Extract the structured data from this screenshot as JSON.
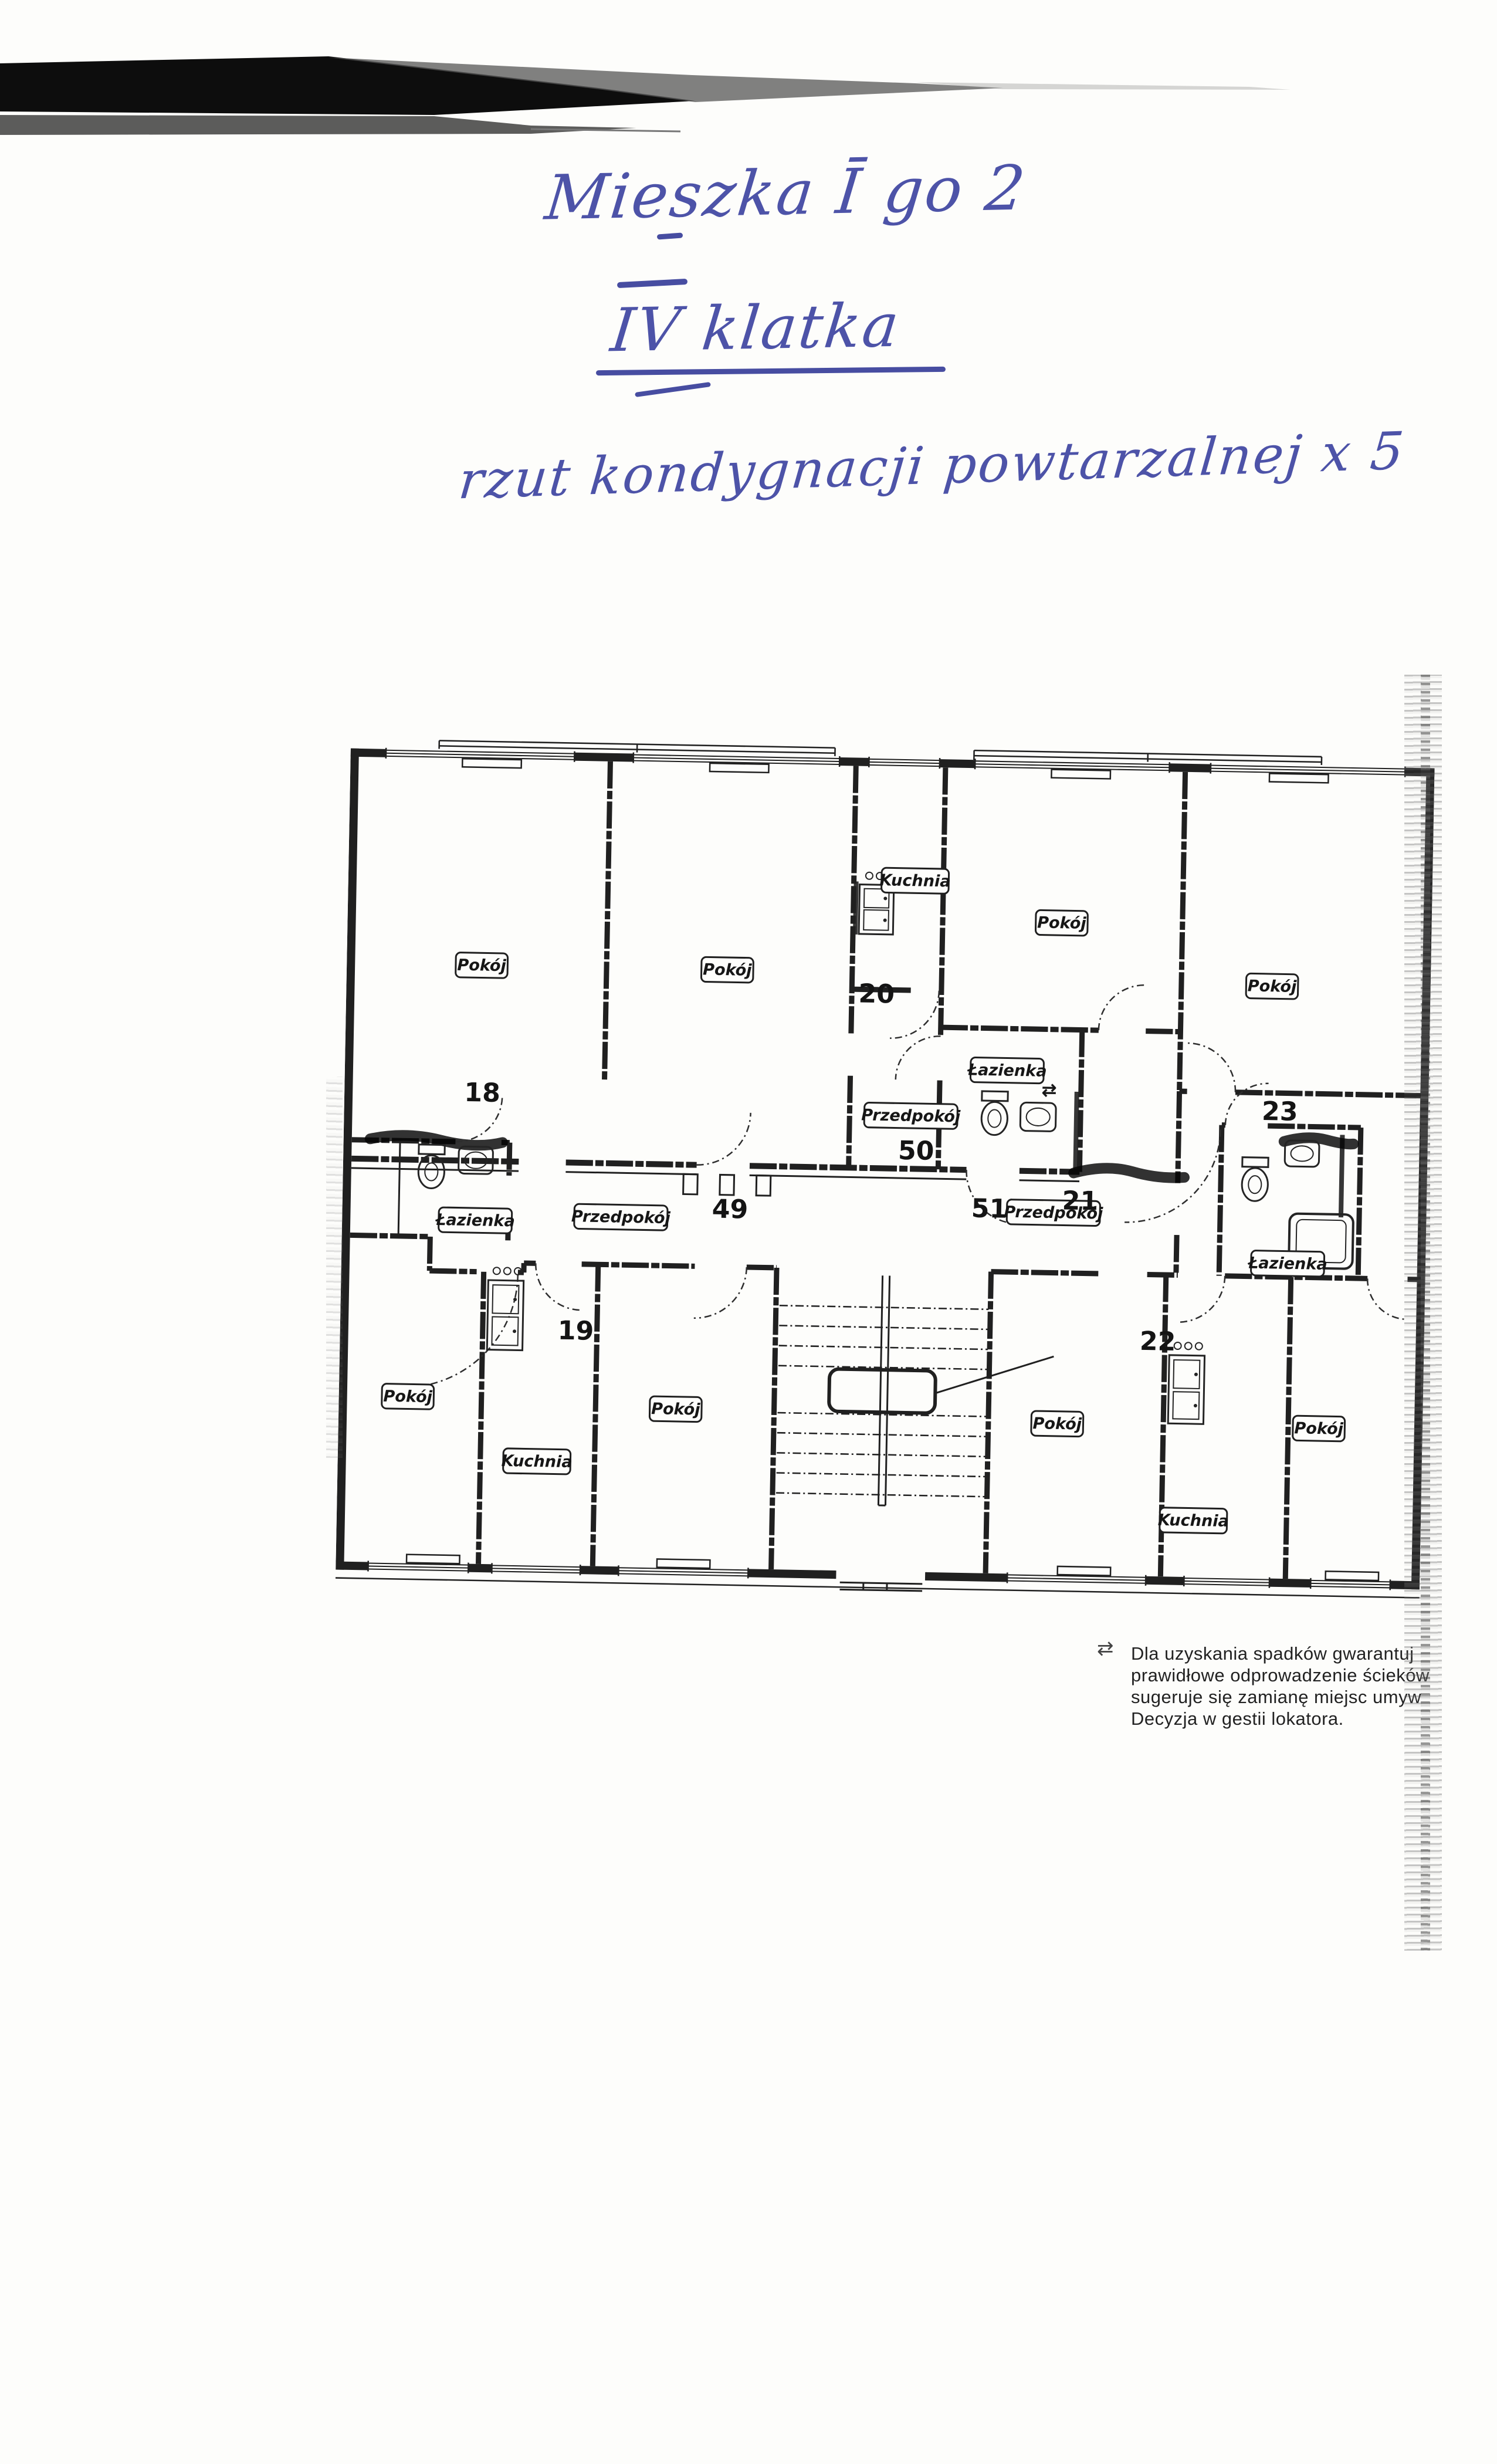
{
  "page": {
    "paper_color": "#fdfdfb"
  },
  "handwriting": {
    "ink_color": "#4d53a8",
    "line1": "Mieszka Ī go 2",
    "line2": "IV klatka",
    "line3": "rzut kondygnacji powtarzalnej x 5"
  },
  "plan": {
    "ink_color": "#202020",
    "room_labels": {
      "pokoj": "Pokój",
      "kuchnia": "Kuchnia",
      "lazienka": "Łazienka",
      "przedpokoj": "Przedpokój"
    },
    "numbers": {
      "n18": "18",
      "n19": "19",
      "n20": "20",
      "n21": "21",
      "n22": "22",
      "n23": "23",
      "n49": "49",
      "n50": "50",
      "n51": "51"
    },
    "swap_marker": "⇄"
  },
  "note": {
    "marker": "⇄",
    "lines": [
      "Dla uzyskania spadków gwarantuj",
      "prawidłowe odprowadzenie ścieków",
      "sugeruje się zamianę miejsc umyw",
      "Decyzja w gestii lokatora."
    ]
  }
}
